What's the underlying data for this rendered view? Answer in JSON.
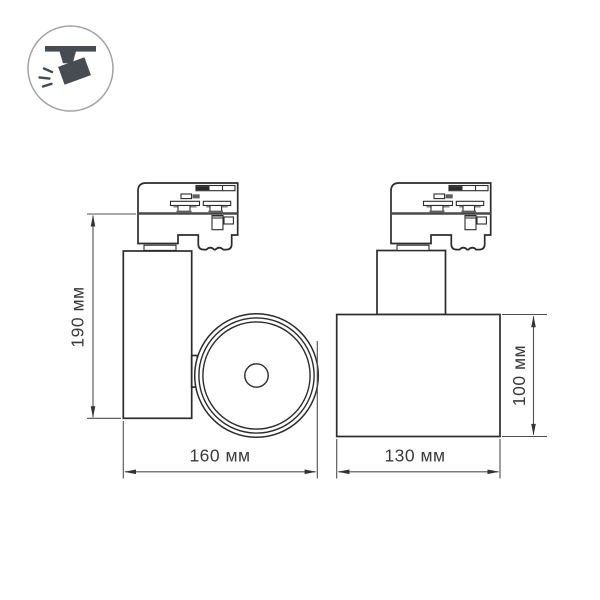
{
  "badge": {
    "icon": "track-spotlight-icon"
  },
  "views": {
    "side": {
      "name": "side-view",
      "height_label": "190 мм",
      "width_label": "160 мм"
    },
    "front": {
      "name": "front-view",
      "width_label": "130 мм",
      "height_label": "100 мм"
    }
  },
  "colors": {
    "background": "#ffffff",
    "drawing_line": "#2c2c2c",
    "dimension_line": "#4f4f4f",
    "dimension_text": "#3b3b3b",
    "icon": "#474c52",
    "badge_ring": "#a3a3a3"
  }
}
